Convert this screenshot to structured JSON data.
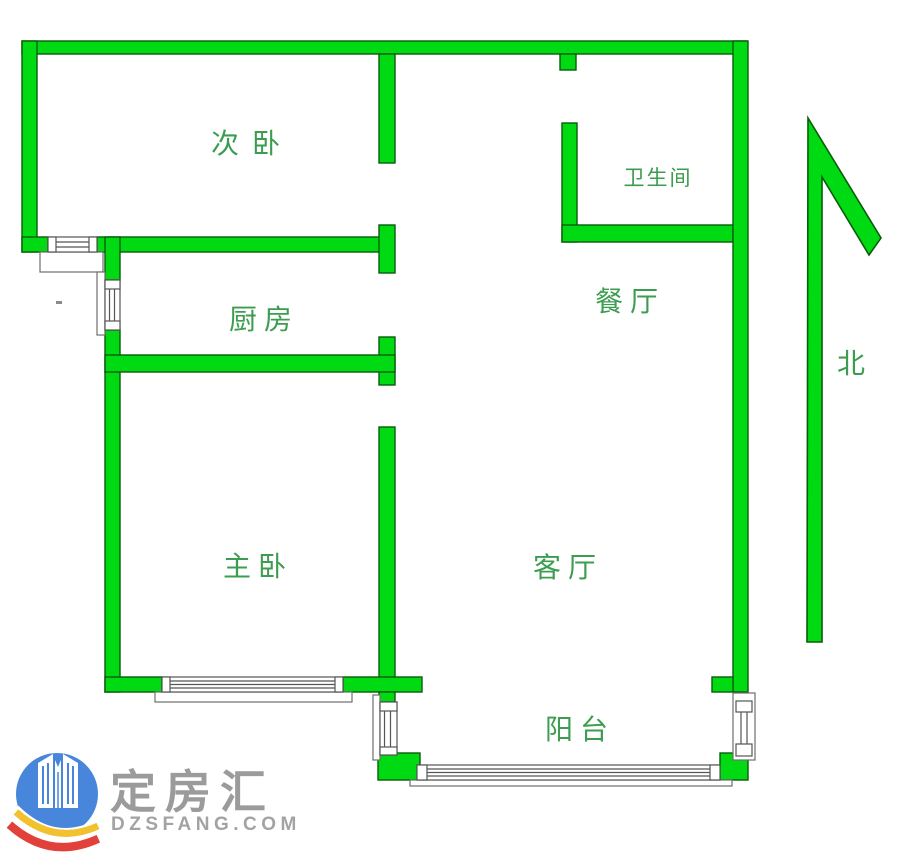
{
  "rooms": {
    "secondary_bedroom": "次卧",
    "bathroom": "卫生间",
    "kitchen": "厨房",
    "dining_room": "餐厅",
    "master_bedroom": "主卧",
    "living_room": "客厅",
    "balcony": "阳台"
  },
  "compass": {
    "north_label": "北"
  },
  "watermark": {
    "brand_name": "定房汇",
    "website": "DZSFANG.COM"
  },
  "colors": {
    "wall_fill": "#00da12",
    "wall_outline": "#0a5c0a",
    "room_label_green": "#3c9d51",
    "window_outline": "#5f5f5f",
    "logo_blue": "#4886dc",
    "logo_red": "#e2403a",
    "logo_yellow": "#f2c12e",
    "logo_text_gray": "#9b9b9b"
  }
}
